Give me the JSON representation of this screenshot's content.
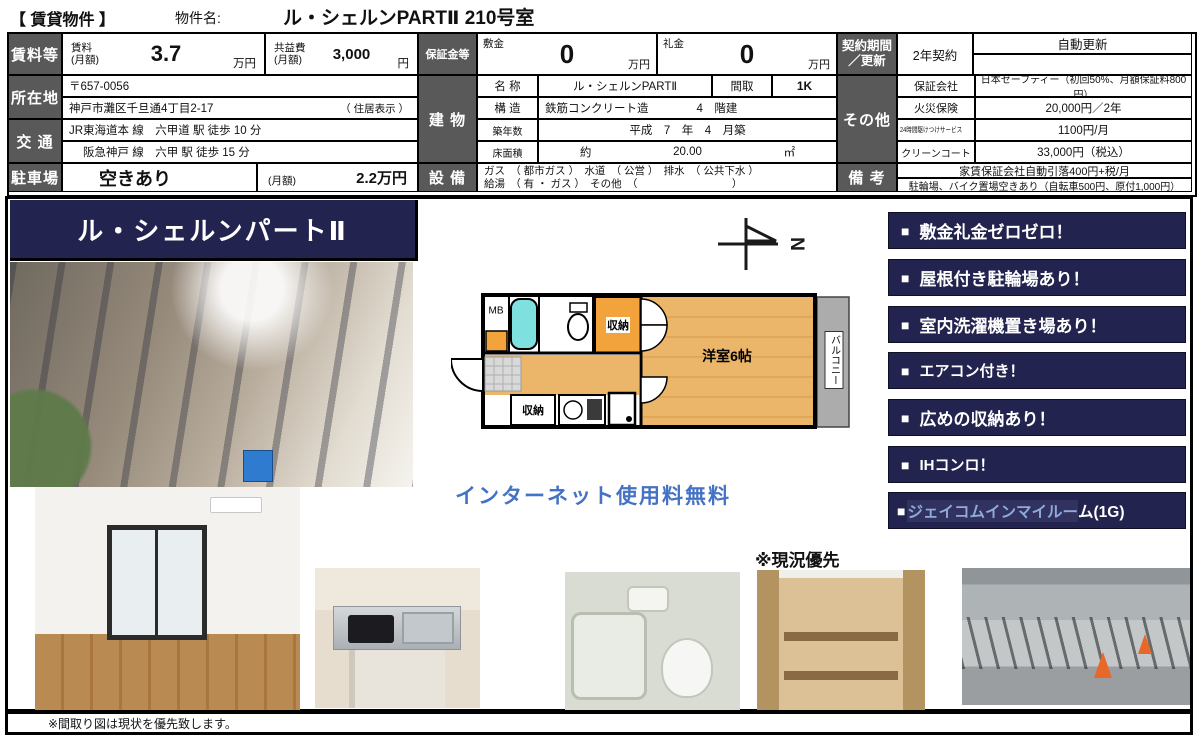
{
  "colors": {
    "label_bg": "#595959",
    "navy": "#23234F",
    "accent_blue": "#4472C4",
    "jcom_blue": "#8FAADC",
    "plan_orange": "#F2A33C",
    "plan_tan": "#EBB56A",
    "plan_cyan": "#7FE0E0",
    "balcony_gray": "#ACACAC"
  },
  "header": {
    "bracket": "【 賃貸物件 】",
    "name_label": "物件名:",
    "property_name": "ル・シェルンPARTⅡ 210号室"
  },
  "rent": {
    "row_label": "賃料等",
    "rent_label": "賃料",
    "rent_sub": "(月額)",
    "rent_value": "3.7",
    "rent_unit": "万円",
    "fee_label": "共益費",
    "fee_sub": "(月額)",
    "fee_value": "3,000",
    "fee_unit": "円"
  },
  "deposit": {
    "row_label": "保証金等",
    "shikikin_label": "敷金",
    "shikikin_value": "0",
    "shikikin_unit": "万円",
    "reikin_label": "礼金",
    "reikin_value": "0",
    "reikin_unit": "万円"
  },
  "location": {
    "row_label": "所在地",
    "postal": "〒657-0056",
    "address": "神戸市灘区千旦通4丁目2-17",
    "note": "（ 住居表示 ）"
  },
  "access": {
    "row_label": "交 通",
    "line1": "JR東海道本 線　六甲道 駅 徒歩 10 分",
    "line2": "阪急神戸 線　六甲 駅 徒歩 15 分"
  },
  "parking": {
    "row_label": "駐車場",
    "status": "空きあり",
    "monthly_label": "(月額)",
    "monthly_value": "2.2万円"
  },
  "building": {
    "row_label": "建 物",
    "name_label": "名 称",
    "name": "ル・シェルンPARTⅡ",
    "layout_label": "間取",
    "layout": "1K",
    "structure_label": "構 造",
    "structure": "鉄筋コンクリート造",
    "floors": "4　階建",
    "age_label": "築年数",
    "age": "平成　7　年　4　月築",
    "area_label": "床面積",
    "area_about": "約",
    "area_value": "20.00",
    "area_unit": "㎡"
  },
  "equipment": {
    "row_label": "設 備",
    "line1": "ガス　（ 都市ガス ）　水道　（ 公営 ）　排水　（ 公共下水 ）",
    "line2": "給湯　（ 有 ・ ガス ）　その他　（　　　　　　　　　）"
  },
  "contract": {
    "row_label_1": "契約期間",
    "row_label_2": "／更新",
    "term": "2年契約",
    "renewal": "自動更新"
  },
  "other": {
    "row_label": "その他",
    "rows": [
      {
        "label": "保証会社",
        "value": "日本セーフティー（初回50%、月額保証料800円）"
      },
      {
        "label": "火災保険",
        "value": "20,000円／2年"
      },
      {
        "label": "24時間駆けつけサービス",
        "value": "1100円/月"
      },
      {
        "label": "クリーンコート",
        "value": "33,000円（税込）"
      }
    ]
  },
  "remarks": {
    "row_label": "備 考",
    "line1": "家賃保証会社自動引落400円+税/月",
    "line2": "駐輪場、バイク置場空きあり（自転車500円、原付1,000円）"
  },
  "lower": {
    "title": "ル・シェルンパートⅡ",
    "internet_note": "インターネット使用料無料",
    "condition_note": "※現況優先",
    "bottom_note": "※間取り図は現状を優先致します。",
    "compass_letter": "N",
    "bullet": "■",
    "features": [
      "敷金礼金ゼロゼロ！",
      "屋根付き駐輪場あり！",
      "室内洗濯機置き場あり！",
      "エアコン付き！",
      "広めの収納あり！",
      "IHコンロ！"
    ],
    "jcom": {
      "highlight": "ジェイコムインマイルー",
      "rest": "ム(1G)"
    },
    "floorplan": {
      "mb": "MB",
      "closet_top": "収納",
      "room": "洋室6帖",
      "balcony": "バルコニー",
      "closet_bottom": "収納"
    }
  }
}
